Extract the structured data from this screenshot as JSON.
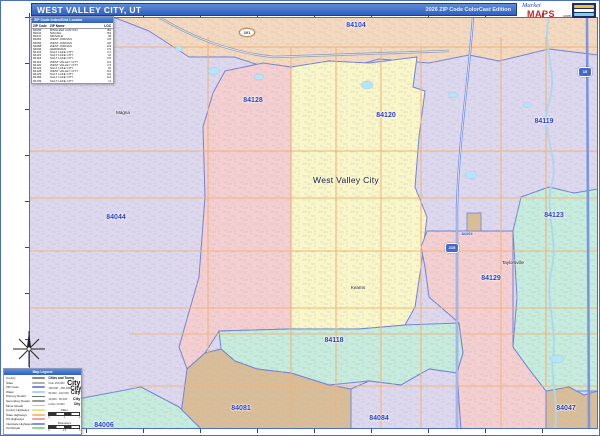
{
  "header": {
    "title": "WEST VALLEY CITY, UT",
    "edition": "2026 ZIP Code ColorCast Edition"
  },
  "logo": {
    "script": "Market",
    "main": "MAPS",
    "suffix": ".com"
  },
  "zip_table": {
    "title": "ZIP Code Index/Grid Locator",
    "columns": [
      "ZIP Code",
      "ZIP Name",
      "LOC"
    ],
    "rows": [
      [
        "84006",
        "BINGHAM CANYON",
        "B9"
      ],
      [
        "84044",
        "MAGNA",
        "B4"
      ],
      [
        "84047",
        "MIDVALE",
        "J8"
      ],
      [
        "84081",
        "WEST JORDAN",
        "C8"
      ],
      [
        "84084",
        "WEST JORDAN",
        "H8"
      ],
      [
        "84088",
        "WEST JORDAN",
        "H9"
      ],
      [
        "84096",
        "HERRIMAN",
        "C9"
      ],
      [
        "84104",
        "SALT LAKE CITY",
        "F1"
      ],
      [
        "84115",
        "SALT LAKE CITY",
        "J2"
      ],
      [
        "84118",
        "SALT LAKE CITY",
        "F5"
      ],
      [
        "84119",
        "WEST VALLEY CITY",
        "H3"
      ],
      [
        "84120",
        "WEST VALLEY CITY",
        "F3"
      ],
      [
        "84123",
        "SALT LAKE CITY",
        "J6"
      ],
      [
        "84128",
        "WEST VALLEY CITY",
        "D3"
      ],
      [
        "84129",
        "SALT LAKE CITY",
        "H6"
      ],
      [
        "84184",
        "SALT LAKE CITY",
        "H4"
      ],
      [
        "84199",
        "SALT LAKE CITY",
        "I1"
      ]
    ]
  },
  "map": {
    "zip_labels": [
      {
        "text": "84104"
      },
      {
        "text": "84128"
      },
      {
        "text": "84120"
      },
      {
        "text": "84119"
      },
      {
        "text": "84044"
      },
      {
        "text": "84123"
      },
      {
        "text": "84129"
      },
      {
        "text": "84118"
      },
      {
        "text": "84081"
      },
      {
        "text": "84084"
      },
      {
        "text": "84047"
      },
      {
        "text": "84006"
      },
      {
        "text": "84104"
      }
    ],
    "city_labels": [
      {
        "text": "West Valley City"
      },
      {
        "text": "Magna"
      },
      {
        "text": "Kearns"
      },
      {
        "text": "Taylorsville"
      }
    ],
    "shields": [
      {
        "text": "215"
      },
      {
        "text": "15"
      },
      {
        "text": "201"
      }
    ],
    "colors": {
      "lavender": "#ddd8ee",
      "peach": "#f5d9bf",
      "pink": "#f5cfd0",
      "yellow": "#f9f6c8",
      "teal": "#c5ecdd",
      "tan": "#d9bd96",
      "boundary": "#7282d4",
      "road_orange": "#f0b27a",
      "interstate_blue": "#7b96e0",
      "water": "#a8d9f0",
      "title_bar": "#3f72cc"
    }
  },
  "legend": {
    "title": "Map Legend",
    "items": [
      {
        "label": "County",
        "color": "#8a8a8a"
      },
      {
        "label": "State",
        "color": "#b0b0b0"
      },
      {
        "label": "ZIP Code",
        "color": "#7b8ad9"
      },
      {
        "label": "Water",
        "color": "#a8d9f0"
      },
      {
        "label": "Primary Roads",
        "color": "#707070"
      },
      {
        "label": "Secondary Roads",
        "color": "#9a9a9a"
      },
      {
        "label": "Minor Roads",
        "color": "#c4c4c4"
      },
      {
        "label": "County Highways",
        "color": "#f2e27e"
      },
      {
        "label": "State Highways",
        "color": "#f5c07a"
      },
      {
        "label": "US Highways",
        "color": "#f2a0a0"
      },
      {
        "label": "Interstate Highways",
        "color": "#7b96e0"
      },
      {
        "label": "Toll Roads",
        "color": "#8fd98f"
      }
    ],
    "cities_title": "Cities and Towns",
    "city_sizes": [
      {
        "range": "Over 250,000",
        "sample": "City",
        "px": 7
      },
      {
        "range": "100,000 - 250,000",
        "sample": "City",
        "px": 6
      },
      {
        "range": "50,000 - 100,000",
        "sample": "City",
        "px": 5
      },
      {
        "range": "10,000 - 50,000",
        "sample": "City",
        "px": 4
      },
      {
        "range": "Under 10,000",
        "sample": "City",
        "px": 3.5
      }
    ],
    "scale": {
      "miles_label": "Miles",
      "km_label": "Kilometers",
      "mi_start": "0",
      "mi_mid": "1",
      "mi_end": "2",
      "km_start": "0",
      "km_mid": "1.5",
      "km_end": "3"
    }
  }
}
